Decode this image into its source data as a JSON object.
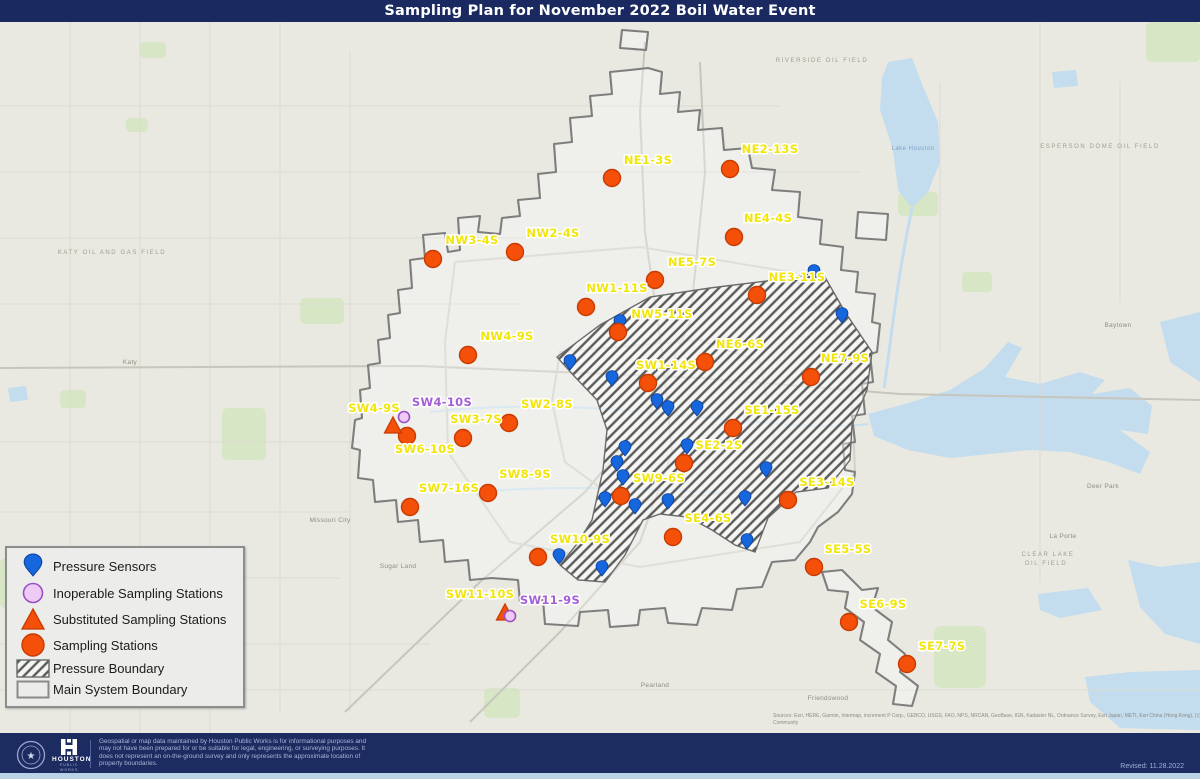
{
  "title": "Sampling Plan for November 2022 Boil Water Event",
  "colors": {
    "navy": "#1a2a60",
    "map_bg": "#e9e9e2",
    "sampling_fill": "#f4500a",
    "sampling_stroke": "#c83b00",
    "sensor_fill": "#1667de",
    "sensor_stroke": "#0a3f9c",
    "inoperable_fill": "#eecbf4",
    "inoperable_stroke": "#9c4fc4",
    "label_yellow": "#f2e50a",
    "label_purple": "#a55fd5",
    "hatch_line": "#5a5a5a",
    "main_boundary": "#7e7e7e",
    "water": "#c3dcee",
    "park": "#d7e6c4"
  },
  "legend": {
    "items": [
      {
        "key": "pressure-sensor",
        "label": "Pressure Sensors"
      },
      {
        "key": "inoperable",
        "label": "Inoperable Sampling Stations"
      },
      {
        "key": "substituted",
        "label": "Substituted Sampling Stations"
      },
      {
        "key": "sampling",
        "label": "Sampling Stations"
      },
      {
        "key": "pressure-boundary",
        "label": "Pressure Boundary"
      },
      {
        "key": "main-boundary",
        "label": "Main System Boundary"
      }
    ]
  },
  "map": {
    "sampling_stations": [
      {
        "label": "NE1-3S",
        "x": 612,
        "y": 156,
        "lx": 648,
        "ly": 142
      },
      {
        "label": "NE2-13S",
        "x": 730,
        "y": 147,
        "lx": 770,
        "ly": 131
      },
      {
        "label": "NE4-4S",
        "x": 734,
        "y": 215,
        "lx": 768,
        "ly": 200
      },
      {
        "label": "NE5-7S",
        "x": 655,
        "y": 258,
        "lx": 692,
        "ly": 244
      },
      {
        "label": "NE3-11S",
        "x": 757,
        "y": 273,
        "lx": 797,
        "ly": 259
      },
      {
        "label": "NW3-4S",
        "x": 433,
        "y": 237,
        "lx": 472,
        "ly": 222
      },
      {
        "label": "NW2-4S",
        "x": 515,
        "y": 230,
        "lx": 553,
        "ly": 215
      },
      {
        "label": "NW1-11S",
        "x": 586,
        "y": 285,
        "lx": 617,
        "ly": 270
      },
      {
        "label": "NW5-11S",
        "x": 618,
        "y": 310,
        "lx": 662,
        "ly": 296
      },
      {
        "label": "NW4-9S",
        "x": 468,
        "y": 333,
        "lx": 507,
        "ly": 318
      },
      {
        "label": "NE6-6S",
        "x": 705,
        "y": 340,
        "lx": 740,
        "ly": 326
      },
      {
        "label": "NE7-9S",
        "x": 811,
        "y": 355,
        "lx": 845,
        "ly": 340
      },
      {
        "label": "SW1-14S",
        "x": 648,
        "y": 361,
        "lx": 666,
        "ly": 347
      },
      {
        "label": "SE1-15S",
        "x": 733,
        "y": 406,
        "lx": 772,
        "ly": 392
      },
      {
        "label": "SW2-8S",
        "x": 509,
        "y": 401,
        "lx": 547,
        "ly": 386
      },
      {
        "label": "SW3-7S",
        "x": 463,
        "y": 416,
        "lx": 476,
        "ly": 401
      },
      {
        "label": "SW6-10S",
        "x": 407,
        "y": 414,
        "lx": 425,
        "ly": 431
      },
      {
        "label": "SE2-2S",
        "x": 684,
        "y": 441,
        "lx": 719,
        "ly": 427
      },
      {
        "label": "SW7-16S",
        "x": 410,
        "y": 485,
        "lx": 449,
        "ly": 470
      },
      {
        "label": "SW8-9S",
        "x": 488,
        "y": 471,
        "lx": 525,
        "ly": 456
      },
      {
        "label": "SW9-6S",
        "x": 621,
        "y": 474,
        "lx": 659,
        "ly": 460
      },
      {
        "label": "SE3-14S",
        "x": 788,
        "y": 478,
        "lx": 827,
        "ly": 464
      },
      {
        "label": "SE4-6S",
        "x": 673,
        "y": 515,
        "lx": 708,
        "ly": 500
      },
      {
        "label": "SW10-9S",
        "x": 538,
        "y": 535,
        "lx": 580,
        "ly": 521
      },
      {
        "label": "SE5-5S",
        "x": 814,
        "y": 545,
        "lx": 848,
        "ly": 531
      },
      {
        "label": "SE6-9S",
        "x": 849,
        "y": 600,
        "lx": 883,
        "ly": 586
      },
      {
        "label": "SE7-7S",
        "x": 907,
        "y": 642,
        "lx": 942,
        "ly": 628
      }
    ],
    "substituted_stations": [
      {
        "label": "SW4-9S",
        "x": 393,
        "y": 404,
        "lx": 374,
        "ly": 390
      },
      {
        "label": "SW11-10S",
        "x": 505,
        "y": 591,
        "lx": 480,
        "ly": 576
      }
    ],
    "inoperable_stations": [
      {
        "label": "SW4-10S",
        "x": 404,
        "y": 395,
        "lx": 442,
        "ly": 384
      },
      {
        "label": "SW11-9S",
        "x": 510,
        "y": 594,
        "lx": 550,
        "ly": 582
      }
    ],
    "pressure_sensors": [
      [
        814,
        249
      ],
      [
        842,
        292
      ],
      [
        620,
        299
      ],
      [
        570,
        339
      ],
      [
        612,
        355
      ],
      [
        657,
        378
      ],
      [
        668,
        385
      ],
      [
        697,
        385
      ],
      [
        687,
        423
      ],
      [
        625,
        425
      ],
      [
        617,
        440
      ],
      [
        623,
        454
      ],
      [
        605,
        476
      ],
      [
        635,
        483
      ],
      [
        668,
        478
      ],
      [
        766,
        446
      ],
      [
        745,
        475
      ],
      [
        747,
        518
      ],
      [
        559,
        533
      ],
      [
        602,
        545
      ]
    ],
    "pressure_boundary_points": "557,335 600,303 650,275 710,266 775,258 822,250 845,290 872,330 867,368 852,403 850,438 828,466 796,470 768,496 755,530 735,523 712,508 688,495 660,492 643,498 625,533 605,560 578,558 560,543 577,522 592,498 603,448 607,408 597,378 575,355",
    "main_system_boundary_paths": [
      "648,46 662,50 660,72 680,70 678,90 700,88 698,108 722,106 724,128 748,126 752,146 775,148 772,168 800,170 798,195 822,198 820,222 843,225 841,248 858,250 856,270 875,272 872,300 880,302 877,330 870,332 873,360 862,362 865,392 852,394 855,420 843,422 845,448 855,450 852,472 838,490 818,505 810,520 795,538 772,540 762,565 737,567 732,588 702,586 697,603 668,601 665,586 640,588 638,603 610,605 608,588 580,590 578,604 545,602 543,578 520,580 518,558 492,556 470,558 468,538 445,540 443,518 420,520 418,498 398,500 396,478 375,480 373,458 358,456 360,428 352,426 355,398 362,396 360,368 370,366 368,343 380,341 378,318 390,316 388,293 400,291 398,268 412,266 410,238 425,236 423,213 445,211 448,230 460,228 458,196 480,194 478,210 500,212 502,196 520,194 518,178 540,176 538,152 556,150 554,122 572,120 570,96 592,94 590,74 612,72 610,50 630,48",
      "858,190 888,192 886,218 856,216",
      "622,8 648,10 646,28 620,26",
      "822,550 842,548 862,568 878,566 872,585 892,600 888,618 905,632 900,650 918,664 912,684 893,682 896,664 876,650 880,632 860,618 864,600 845,586 848,570 828,568"
    ],
    "place_labels": [
      {
        "text": "KATY OIL AND GAS FIELD",
        "x": 112,
        "y": 232,
        "cls": "field"
      },
      {
        "text": "ESPERSON DOME OIL FIELD",
        "x": 1100,
        "y": 126,
        "cls": "field"
      },
      {
        "text": "RIVERSIDE OIL FIELD",
        "x": 822,
        "y": 40,
        "cls": "field"
      },
      {
        "text": "CLEAR LAKE",
        "x": 1048,
        "y": 534,
        "cls": "field"
      },
      {
        "text": "OIL FIELD",
        "x": 1046,
        "y": 543,
        "cls": "field"
      },
      {
        "text": "Lake Houston",
        "x": 913,
        "y": 128,
        "cls": "water"
      },
      {
        "text": "Deer Park",
        "x": 1103,
        "y": 466,
        "cls": "city"
      },
      {
        "text": "La Porte",
        "x": 1063,
        "y": 516,
        "cls": "city"
      },
      {
        "text": "Baytown",
        "x": 1118,
        "y": 305,
        "cls": "city"
      },
      {
        "text": "Friendswood",
        "x": 828,
        "y": 678,
        "cls": "city"
      },
      {
        "text": "Pearland",
        "x": 655,
        "y": 665,
        "cls": "city"
      },
      {
        "text": "Missouri City",
        "x": 330,
        "y": 500,
        "cls": "city"
      },
      {
        "text": "Sugar Land",
        "x": 398,
        "y": 546,
        "cls": "city"
      },
      {
        "text": "Katy",
        "x": 130,
        "y": 342,
        "cls": "city"
      }
    ],
    "attribution_line1": "Sources: Esri, HERE, Garmin, Intermap, increment P Corp., GEBCO, USGS, FAO, NPS, NRCAN, GeoBase, IGN, Kadaster NL, Ordnance Survey, Esri Japan, METI, Esri China (Hong Kong), (c) OpenStreetMap contributors, and the GIS User",
    "attribution_line2": "Community"
  },
  "footer": {
    "agency": "HOUSTON",
    "agency_sub": "PUBLIC WORKS",
    "disclaimer": "Geospatial or map data maintained by Houston Public Works is for informational purposes and may not have been prepared for or be suitable for legal, engineering, or surveying purposes. It does not represent an on-the-ground survey and only represents the approximate location of property boundaries.",
    "revised": "Revised: 11.28.2022"
  }
}
